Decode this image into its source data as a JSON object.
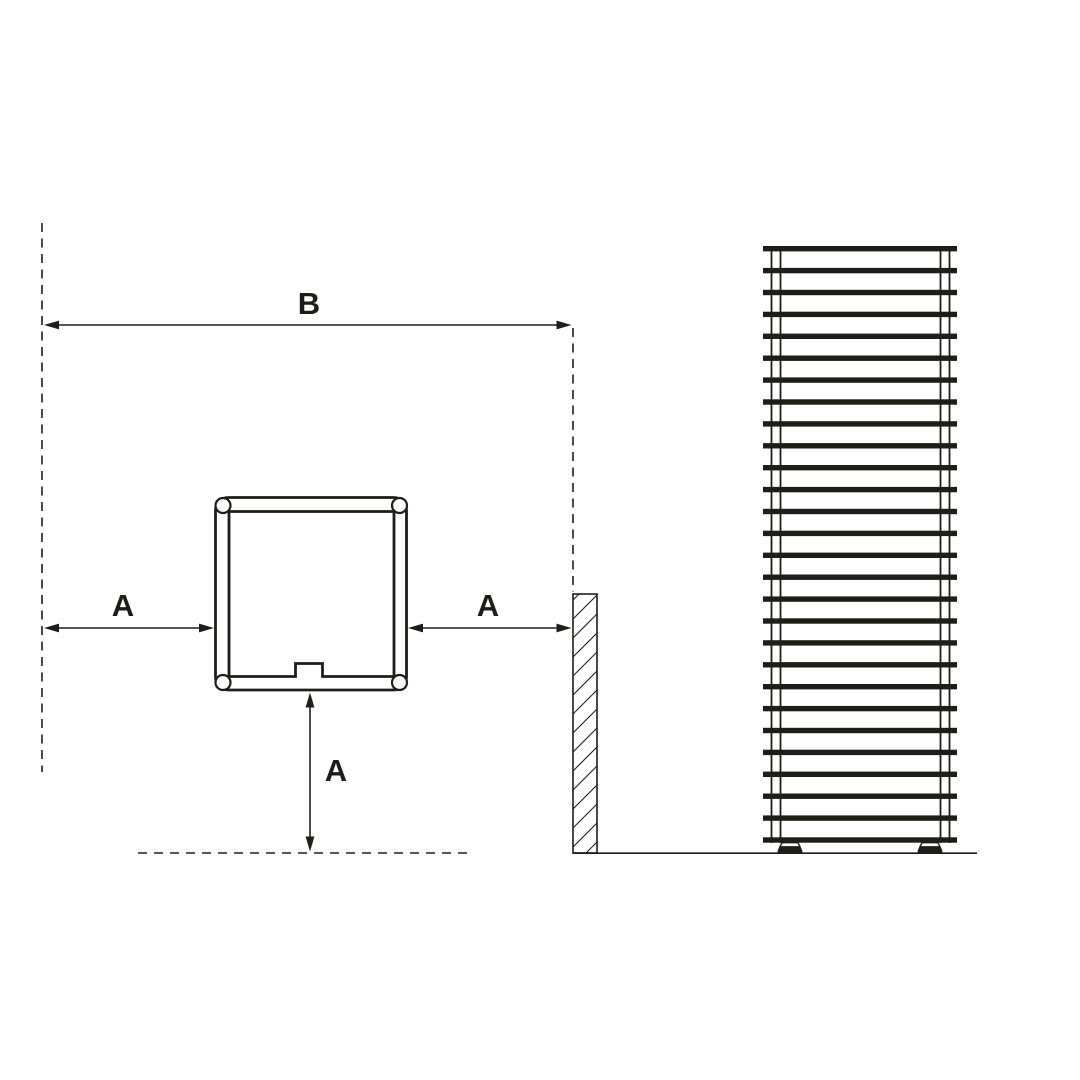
{
  "canvas": {
    "background": "#ffffff",
    "line_color": "#1d1d1b"
  },
  "dimensions": {
    "b_label": "B",
    "a_left_label": "A",
    "a_right_label": "A",
    "a_bottom_label": "A"
  },
  "figure": {
    "tower": {
      "slat_count": 28,
      "slat_top_y": 246,
      "slat_spacing": 21.9,
      "slat_x": 763,
      "slat_width": 194,
      "slat_height": 5.4
    },
    "wall": {
      "hatch_spacing": 19,
      "x_left": 573,
      "x_right": 597,
      "y_top": 594,
      "y_bottom": 853
    }
  }
}
